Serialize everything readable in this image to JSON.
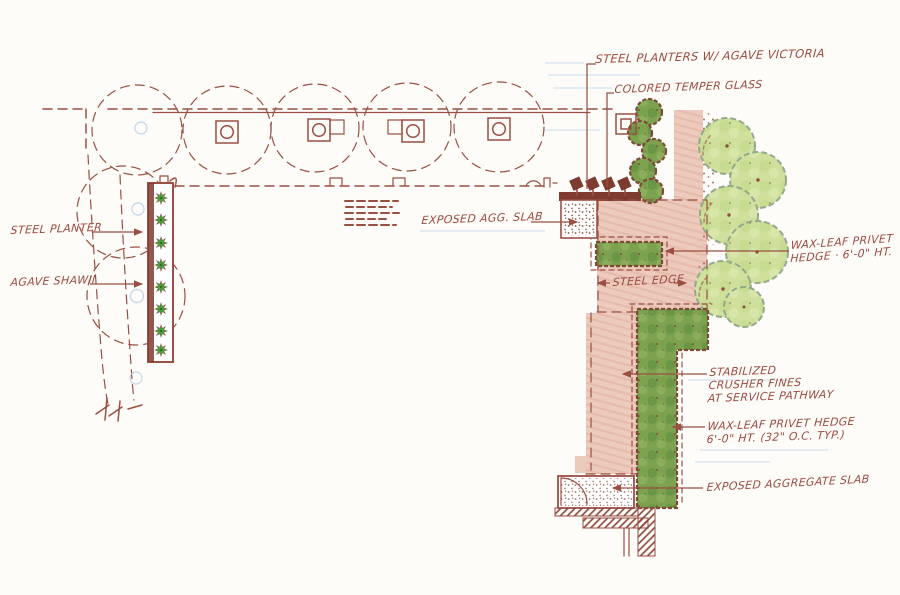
{
  "document": {
    "type": "hand-drawn landscape architecture plan sketch"
  },
  "palette": {
    "ink": "#9a4f43",
    "ink_dark": "#7e3b2f",
    "label": "#9c4b40",
    "paper": "#fdfcf9",
    "path_pink": "#eccabc",
    "hedge_green": "#7ca24f",
    "hedge_outline": "#7d4a38",
    "tree_green": "#cfe09d",
    "tree_outline": "#92aa8b",
    "agave_green": "#4f9b3f",
    "guide_blue": "#a9c9e4"
  },
  "annotations": {
    "steel_planters": {
      "text": "STEEL PLANTERS W/ AGAVE VICTORIA"
    },
    "colored_glass": {
      "text": "COLORED TEMPER GLASS"
    },
    "exposed_agg_slab": {
      "text": "EXPOSED AGG. SLAB"
    },
    "privet_hedge_upper": {
      "line1": "WAX-LEAF PRIVET",
      "line2": "HEDGE · 6'-0\" HT."
    },
    "steel_edge": {
      "text": "STEEL EDGE"
    },
    "crusher_fines": {
      "line1": "STABILIZED",
      "line2": "CRUSHER FINES",
      "line3": "AT SERVICE PATHWAY"
    },
    "privet_hedge_lower": {
      "line1": "WAX-LEAF PRIVET HEDGE",
      "line2": "6'-0\" HT. (32\" O.C. TYP.)"
    },
    "exposed_aggregate_slab": {
      "text": "EXPOSED AGGREGATE SLAB"
    },
    "steel_planter": {
      "text": "STEEL PLANTER"
    },
    "agave_shawii": {
      "text": "AGAVE SHAWII"
    }
  }
}
